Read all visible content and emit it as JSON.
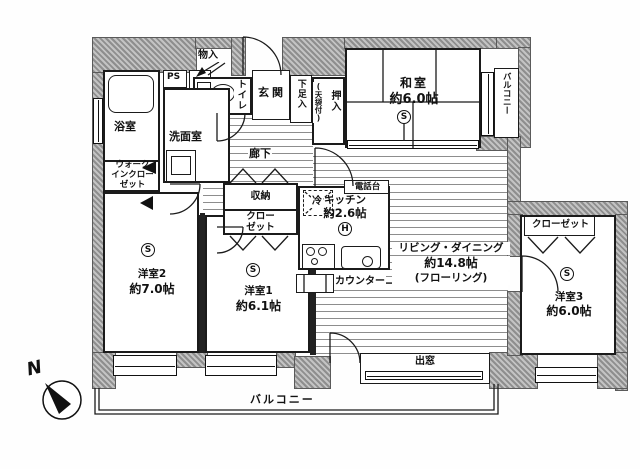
{
  "labels": {
    "monoire": "物入",
    "ps": "PS",
    "toilet": "トイレ",
    "genkan": "玄関",
    "shoe_cabinet": "下足入",
    "oshiire": "押入",
    "oshiire_note": "(天袋付)",
    "washitsu_name": "和室",
    "washitsu_size": "約6.0帖",
    "balcony_side": "バルコニー",
    "bathroom": "浴室",
    "washroom": "洗面室",
    "walkin_closet": "ウォーク\nインクロー\nゼット",
    "hallway": "廊下",
    "storage": "収納",
    "closet_center": "クロー\nゼット",
    "fridge": "冷",
    "phone_stand": "電話台",
    "kitchen_name": "キッチン",
    "kitchen_size": "約2.6帖",
    "living_name": "リビング・ダイニング",
    "living_size": "約14.8帖",
    "living_note": "(フローリング)",
    "counter": "カウンター",
    "closet_right": "クローゼット",
    "room3_name": "洋室3",
    "room3_size": "約6.0帖",
    "room2_name": "洋室2",
    "room2_size": "約7.0帖",
    "room1_name": "洋室1",
    "room1_size": "約6.1帖",
    "bay_window": "出窓",
    "balcony_bottom": "バルコニー",
    "north": "N",
    "symbol_s": "S",
    "symbol_h": "H"
  },
  "colors": {
    "wall": "#8e8e8e",
    "line": "#1b1b1b",
    "background": "#ffffff"
  }
}
